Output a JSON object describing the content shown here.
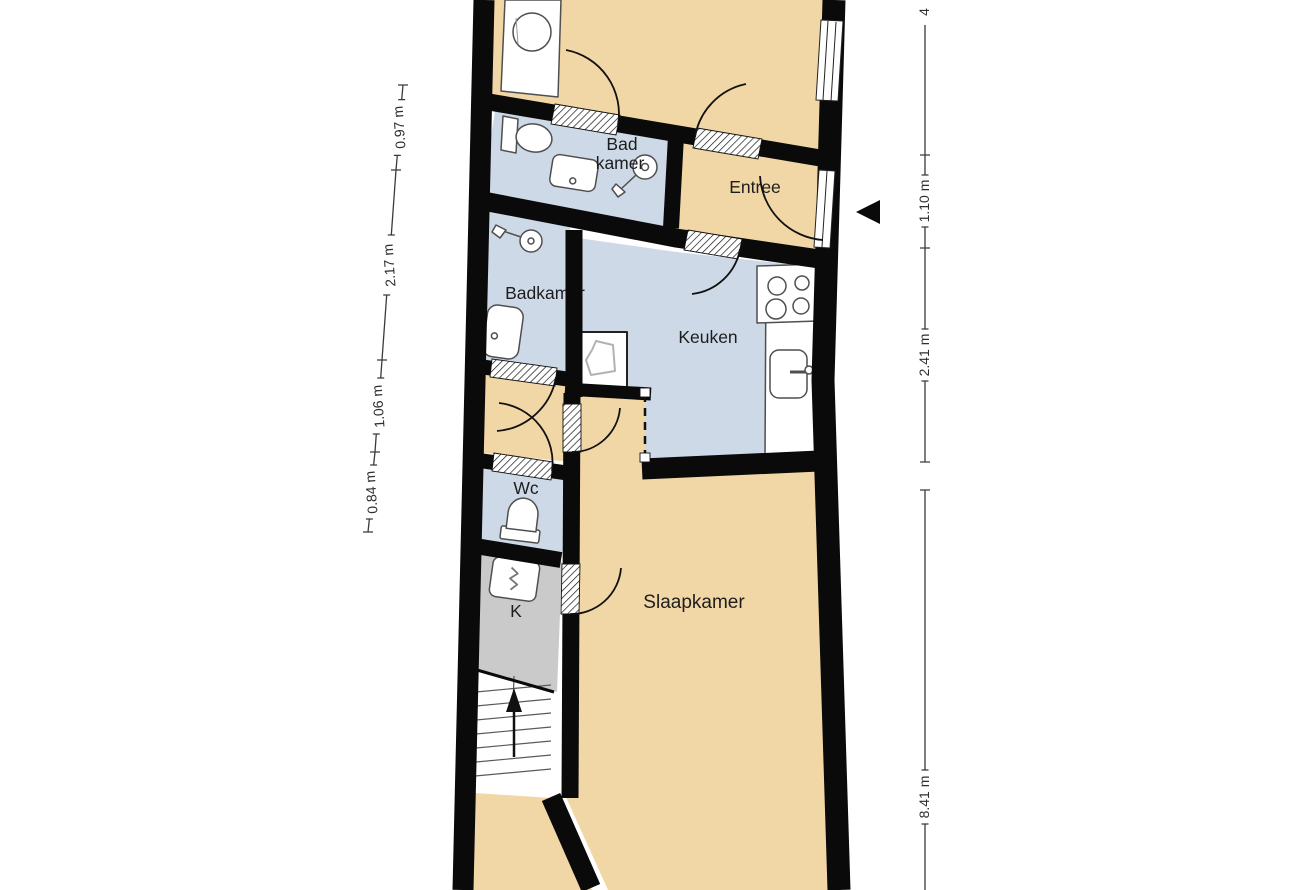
{
  "plan_type": "floorplan",
  "rooms": {
    "bad_line1": "Bad",
    "bad_line2": "kamer",
    "entree": "Entree",
    "badkamer": "Badkamer",
    "keuken": "Keuken",
    "wc": "Wc",
    "k": "K",
    "slaapkamer": "Slaapkamer"
  },
  "dimensions": {
    "left": [
      "0.97 m",
      "2.17 m",
      "1.06 m",
      "0.84 m"
    ],
    "right_top_truncated": "4",
    "right": [
      "1.10 m",
      "2.41 m",
      "8.41 m"
    ]
  },
  "colors": {
    "floor_living": "#f2d7a6",
    "floor_wet": "#cdd9e7",
    "floor_closet": "#cacaca",
    "floor_stairs": "#ffffff",
    "wall": "#0a0a0a",
    "fixture_stroke": "#4f4f4f",
    "dimension_line": "#3a3a3a"
  }
}
